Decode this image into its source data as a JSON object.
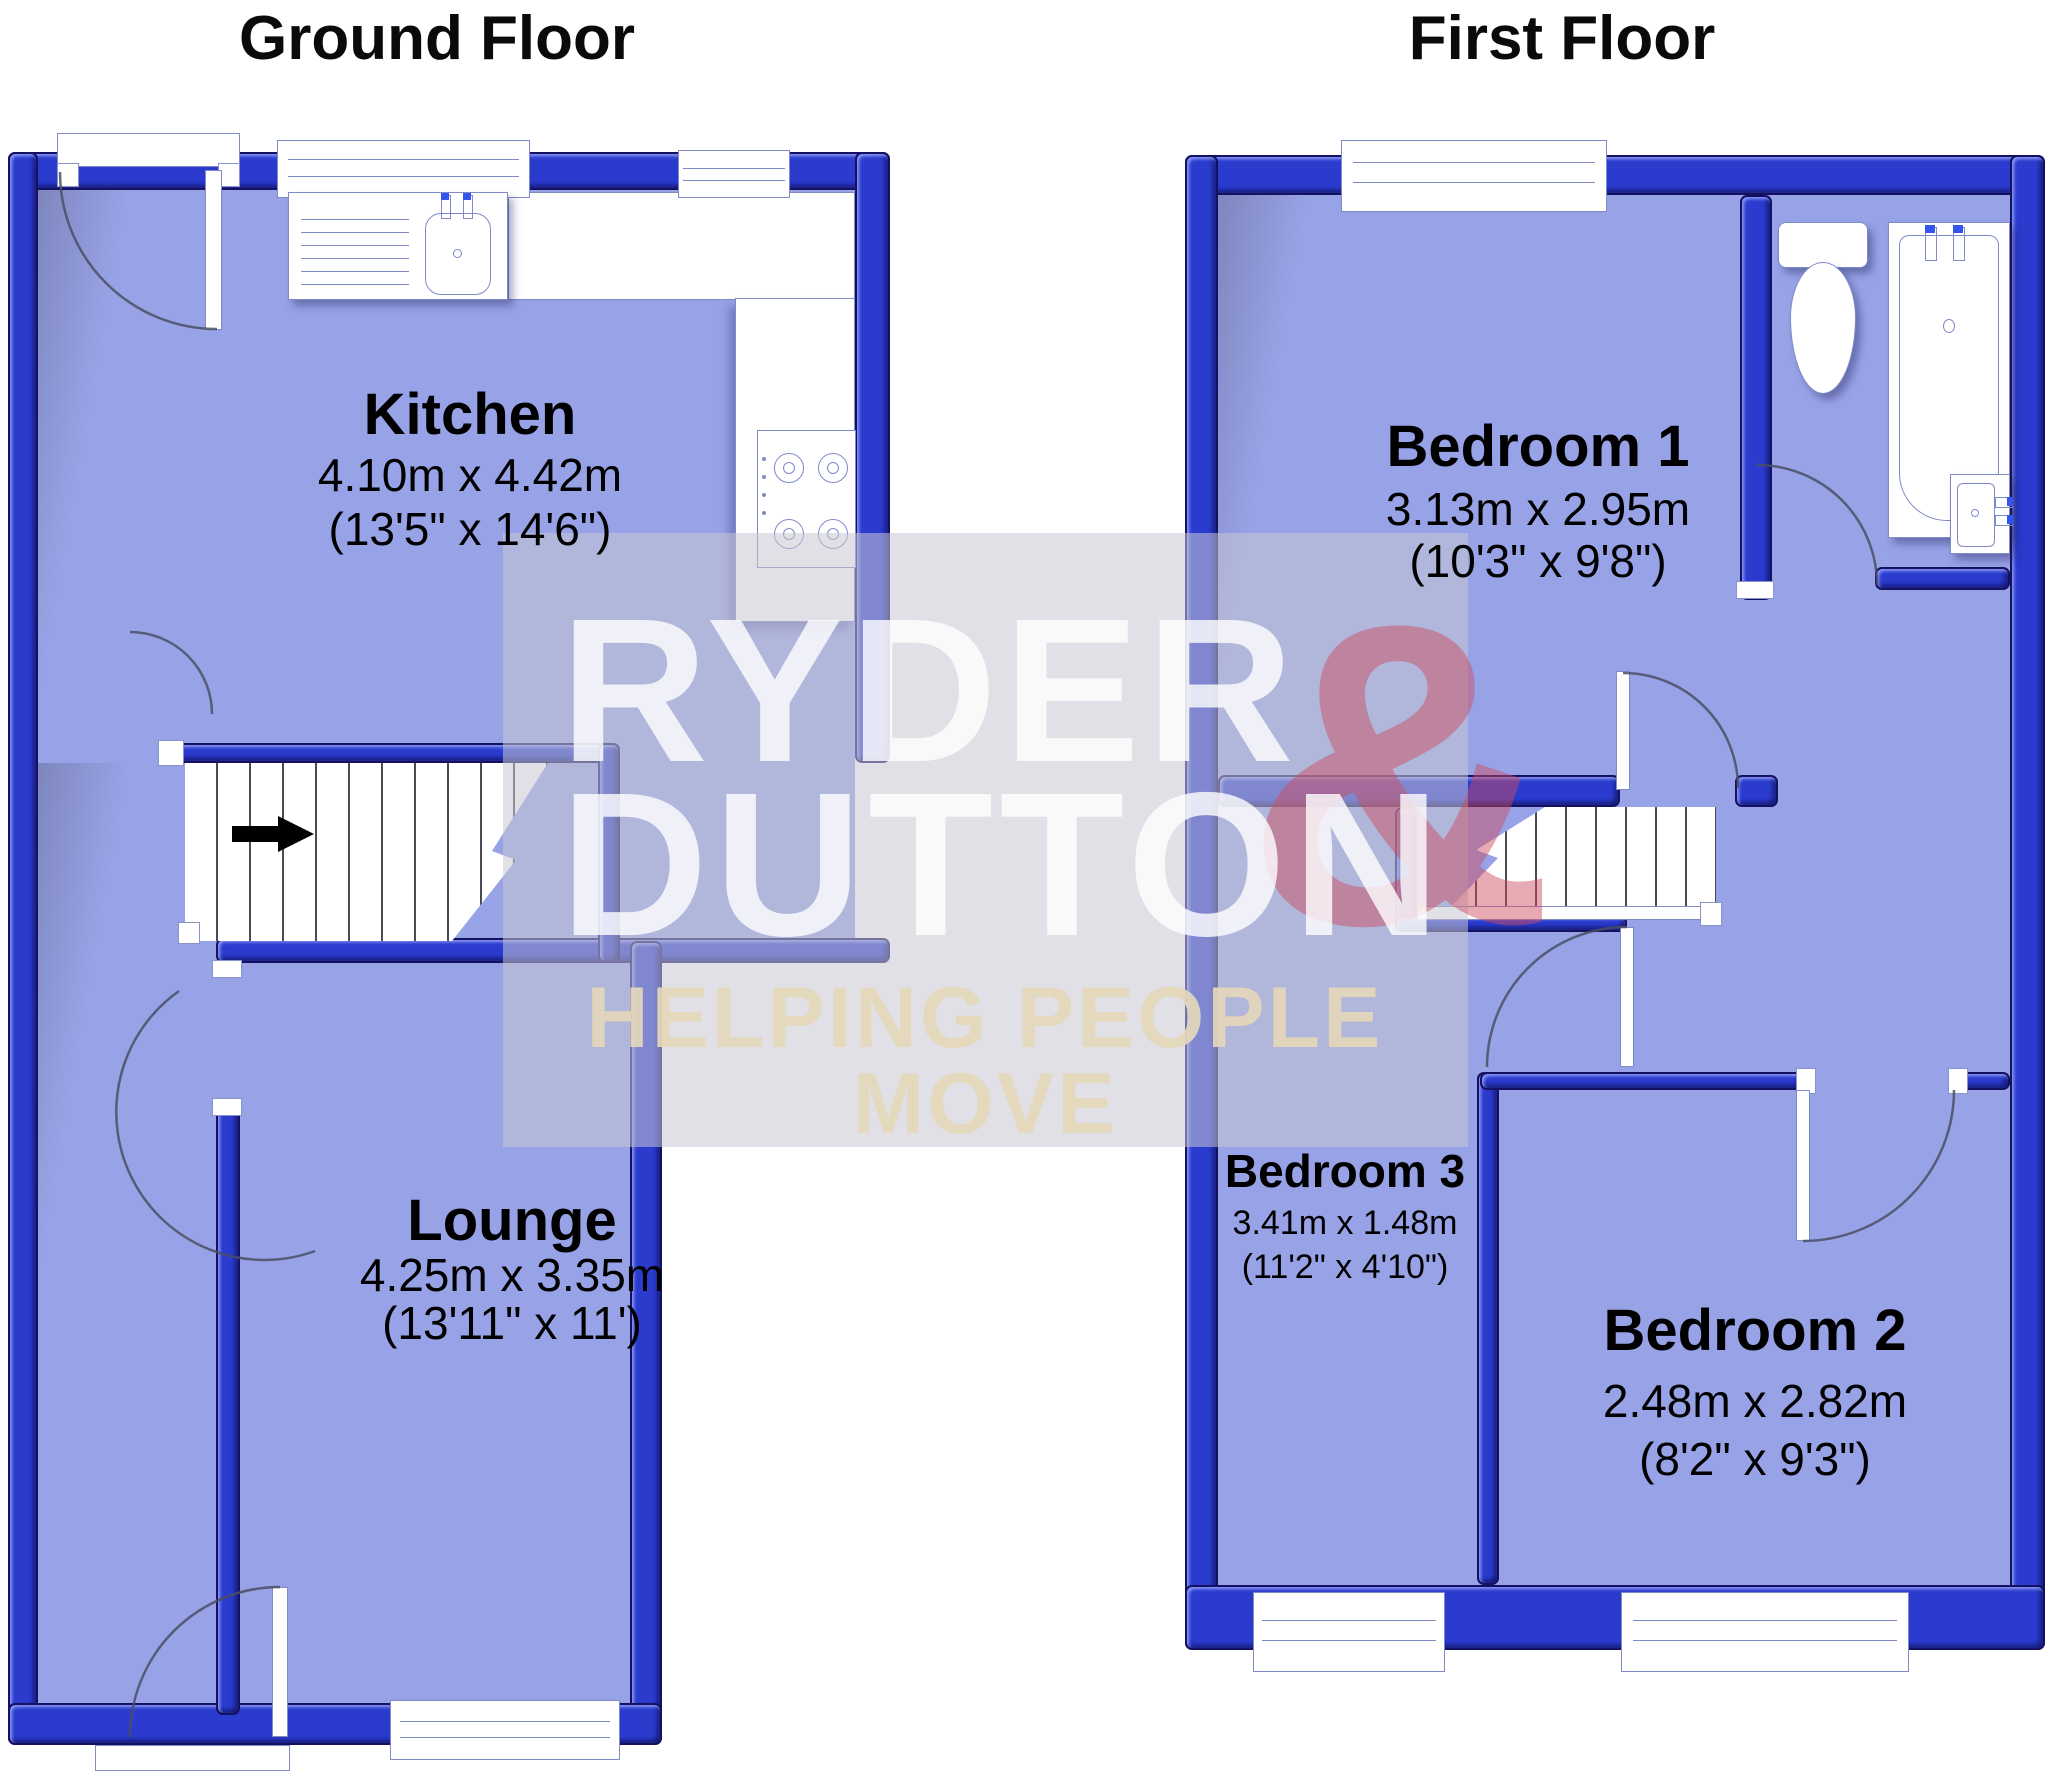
{
  "ground_floor": {
    "title": "Ground Floor",
    "rooms": {
      "kitchen": {
        "name": "Kitchen",
        "metric": "4.10m x 4.42m",
        "imperial": "(13'5\" x 14'6\")"
      },
      "lounge": {
        "name": "Lounge",
        "metric": "4.25m x 3.35m",
        "imperial": "(13'11\" x 11')"
      }
    }
  },
  "first_floor": {
    "title": "First Floor",
    "rooms": {
      "bedroom1": {
        "name": "Bedroom 1",
        "metric": "3.13m x 2.95m",
        "imperial": "(10'3\" x 9'8\")"
      },
      "bedroom2": {
        "name": "Bedroom 2",
        "metric": "2.48m x 2.82m",
        "imperial": "(8'2\" x 9'3\")"
      },
      "bedroom3": {
        "name": "Bedroom 3",
        "metric": "3.41m x 1.48m",
        "imperial": "(11'2\" x 4'10\")"
      }
    }
  },
  "watermark": {
    "brand_line1": "RYDER",
    "brand_amp": "&",
    "brand_line2": "DUTTON",
    "tagline": "HELPING PEOPLE MOVE"
  },
  "colors": {
    "wall_blue": "#2a3bce",
    "room_fill": "#98a3e7",
    "amp_red": "#cc4c5e",
    "tagline_beige": "#e4d7ba"
  }
}
